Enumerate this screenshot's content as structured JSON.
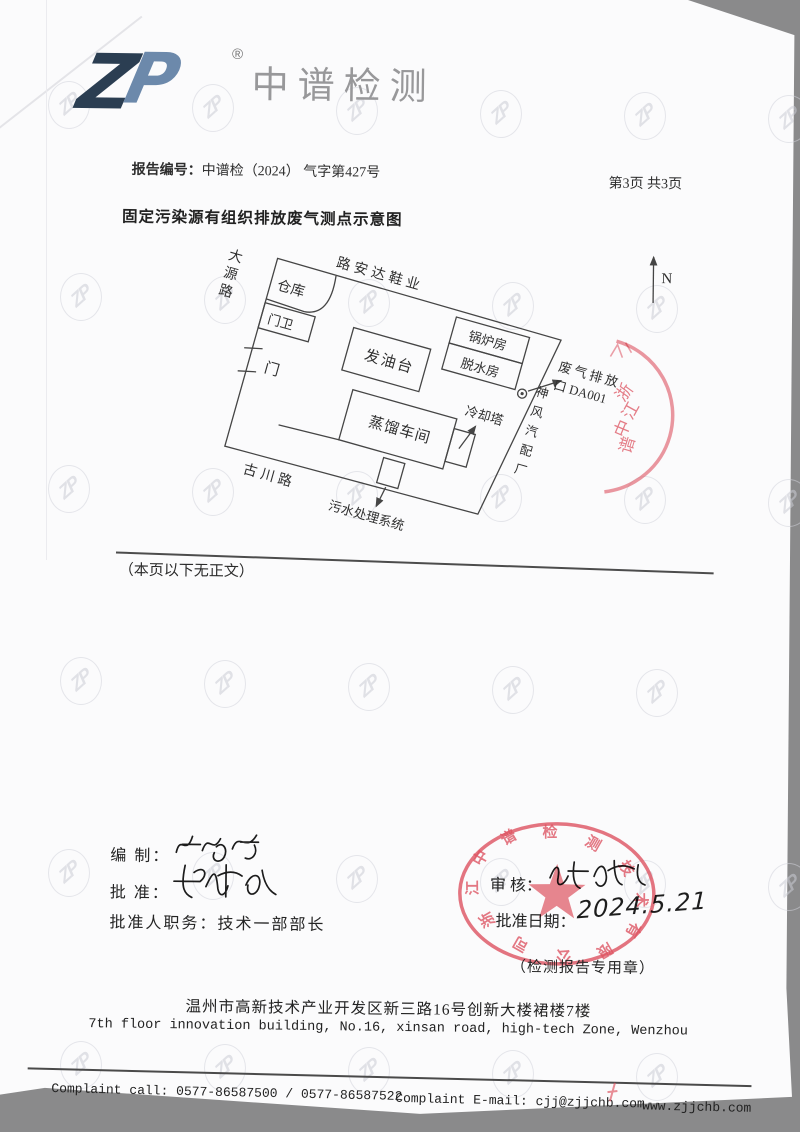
{
  "colors": {
    "stamp_red": "#dd5260",
    "ink": "#454545",
    "logo_navy": "#2b3e52",
    "logo_blue": "#5c7da2",
    "brand_gray": "#98989a"
  },
  "header": {
    "logo_text": "ZP",
    "registered_mark": "®",
    "brand": "中谱检测",
    "report_no_label": "报告编号：",
    "report_no": "中谱检（2024） 气字第427号",
    "page_info": "第3页 共3页"
  },
  "title": "固定污染源有组织排放废气测点示意图",
  "diagram": {
    "labels": {
      "road_top": "路安达鞋业",
      "road_left": "大源路",
      "road_bottom": "古川路",
      "neighbor_right": "神风汽配厂",
      "warehouse": "仓库",
      "guard": "门卫",
      "gate": "门",
      "oil_platform": "发油台",
      "boiler": "锅炉房",
      "dewater": "脱水房",
      "distillation": "蒸馏车间",
      "cooling_tower": "冷却塔",
      "sewage_box": "污水处理系统",
      "outlet_line1": "废气排放",
      "outlet_line2": "口 DA001",
      "north": "N"
    }
  },
  "side_stamp": {
    "text": "浙江中谱"
  },
  "end_note": "（本页以下无正文）",
  "signatures": {
    "prepared_label": "编  制：",
    "approved_label": "批  准：",
    "approver_title_label": "批准人职务：",
    "approver_title": "技术一部部长",
    "reviewed_label": "审  核：",
    "approval_date_label": "批准日期：",
    "approval_date": "2024.5.21",
    "stamp_text": "浙江中谱检测技术有限公司",
    "stamp_caption": "（检测报告专用章）"
  },
  "watermark": {
    "text": "ZP"
  },
  "footer": {
    "address_cn": "温州市高新技术产业开发区新三路16号创新大楼裙楼7楼",
    "address_en": "7th floor innovation building, No.16, xinsan road, high-tech Zone, Wenzhou",
    "complaint_call": "Complaint call: 0577-86587500 / 0577-86587522",
    "complaint_email": "Complaint E-mail: cjj@zjjchb.com",
    "website": "www.zjjchb.com"
  }
}
